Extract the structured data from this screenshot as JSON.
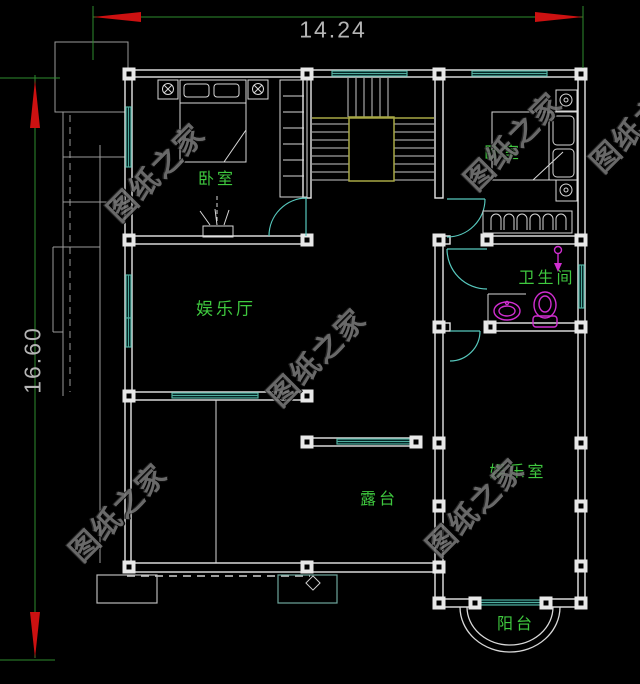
{
  "plan": {
    "dim_top": "14.24",
    "dim_left": "16.60",
    "watermark_text": "图纸之家",
    "rooms": {
      "bedroom_left": "卧室",
      "bedroom_right": "卧室",
      "recreation_hall": "娱乐厅",
      "bathroom": "卫生间",
      "recreation_room": "娱乐室",
      "terrace": "露台",
      "balcony": "阳台"
    },
    "colors": {
      "background": "#000000",
      "wall": "#e8e8e8",
      "window": "#4fae9e",
      "door": "#57c8bd",
      "stair": "#a8a845",
      "fixture": "#d02ed0",
      "room_label": "#3fc93f",
      "dimension_line": "#2e8b2e",
      "dimension_arrow": "#cc1111",
      "dimension_text": "#b5b5b5",
      "watermark": "#757575"
    }
  }
}
